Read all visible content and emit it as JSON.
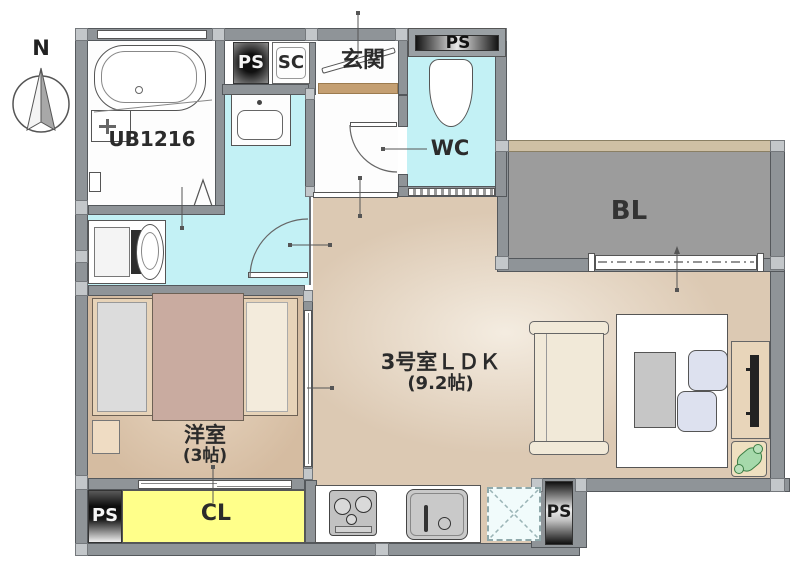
{
  "plan": {
    "compass_label": "N",
    "rooms": {
      "unit_bath": {
        "label": "UB1216"
      },
      "entrance": {
        "label": "玄関"
      },
      "shoe_cupboard": {
        "label": "SC"
      },
      "toilet": {
        "label": "WC"
      },
      "balcony": {
        "label": "BL"
      },
      "living": {
        "label": "3号室ＬＤＫ",
        "size": "(9.2帖)"
      },
      "western_room": {
        "label": "洋室",
        "size": "(3帖)"
      },
      "closet": {
        "label": "CL"
      }
    },
    "pipe_shafts": {
      "top_left": "PS",
      "toilet_side": "PS",
      "bottom_left": "PS",
      "kitchen_side": "PS"
    },
    "colors": {
      "wall": "#8f9498",
      "pillar": "#c3c7ca",
      "wet_area_floor": "#c3f1f5",
      "wood_floor": "#dcc9b3",
      "western_room_floor": "#d6bda3",
      "closet_fill": "#ffff8a",
      "balcony_fill": "#9c9c9c",
      "entrance_step": "#c49f72",
      "bed_cover": "#c9aba0",
      "plant_green": "#a6d9ab"
    }
  }
}
